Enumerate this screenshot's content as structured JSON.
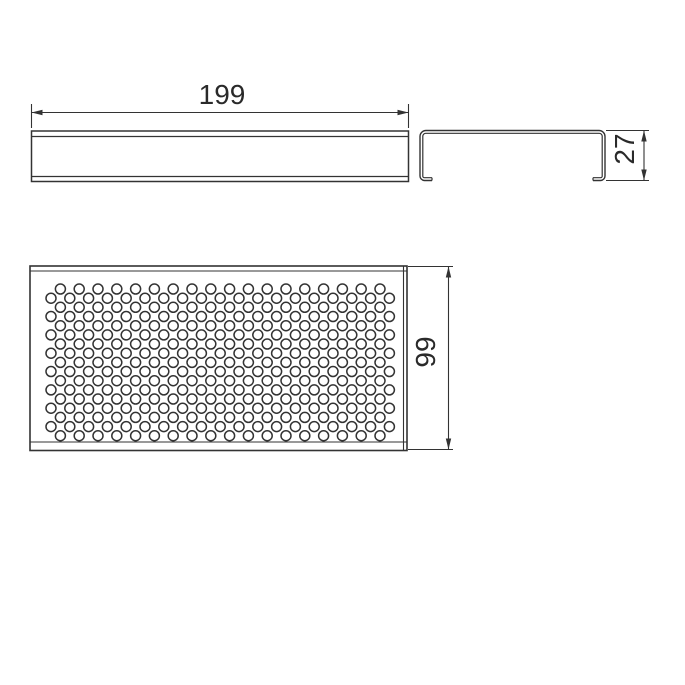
{
  "page": {
    "background": "#ffffff"
  },
  "drawing": {
    "line_color": "#333333",
    "text_color": "#2a2a2a",
    "dimensions": {
      "length": {
        "label": "199"
      },
      "height": {
        "label": "27"
      },
      "width": {
        "label": "99"
      }
    },
    "views": {
      "front_view": {
        "name": "channel-front-view"
      },
      "end_view": {
        "name": "channel-end-profile-view"
      },
      "top_view": {
        "name": "perforated-plate-top-view",
        "hole_pattern": {
          "rows": 17,
          "row_start_y": 289,
          "row_pitch_y": 9.17,
          "hole_radius": 5,
          "hole_stroke_width": 1.5,
          "even_row": {
            "start_x": 60.4,
            "pitch_x": 18.8,
            "count": 18
          },
          "odd_row": {
            "start_x": 51.0,
            "pitch_x": 18.8,
            "count": 19
          }
        }
      }
    }
  }
}
